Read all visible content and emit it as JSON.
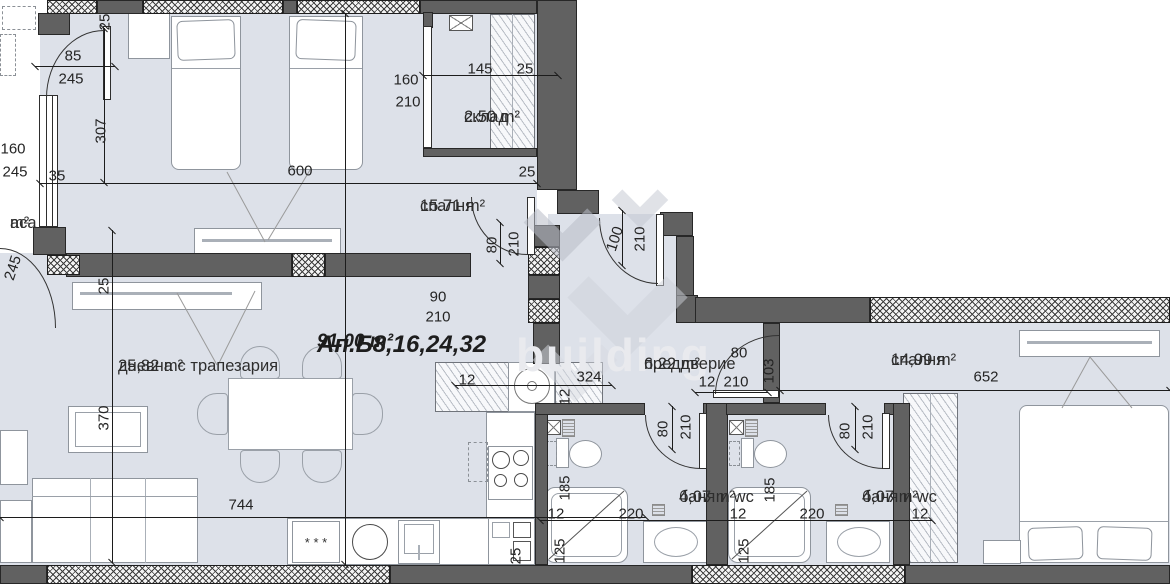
{
  "plan": {
    "apartment_title": "Ап.Б8,16,24,32",
    "apartment_total_area": "91.00 m²",
    "watermark_text": "building",
    "colors": {
      "floor": "#dde1e9",
      "wall_dark": "#616161",
      "dimension_line": "#1c1c1c"
    },
    "rooms": [
      {
        "name": "спалня",
        "area": "15.71 m²"
      },
      {
        "name": "склад",
        "area": "2.50 m²"
      },
      {
        "name": "дневна с трапезария",
        "area": "25,82 m²"
      },
      {
        "name": "преддверие",
        "area": "6.22 m²"
      },
      {
        "name": "спалня",
        "area": "14,99 m²"
      },
      {
        "name": "баня и wc",
        "area": "4,07 m²"
      },
      {
        "name": "баня и wc",
        "area": "4,07 m²"
      },
      {
        "name_partial": "аса",
        "area_partial": "m²"
      }
    ],
    "kitchen": {
      "dishwasher_symbol": "* * *"
    },
    "dimensions": [
      {
        "t": "25",
        "x": 105,
        "y": 22,
        "r": 90
      },
      {
        "t": "85",
        "x": 73,
        "y": 56,
        "r": 0
      },
      {
        "t": "245",
        "x": 71,
        "y": 79,
        "r": 0
      },
      {
        "t": "307",
        "x": 101,
        "y": 131,
        "r": 90
      },
      {
        "t": "160",
        "x": 13,
        "y": 149,
        "r": 0
      },
      {
        "t": "245",
        "x": 15,
        "y": 172,
        "r": 0
      },
      {
        "t": "35",
        "x": 57,
        "y": 176,
        "r": 0
      },
      {
        "t": "600",
        "x": 300,
        "y": 171,
        "r": 0
      },
      {
        "t": "145",
        "x": 480,
        "y": 69,
        "r": 0
      },
      {
        "t": "25",
        "x": 525,
        "y": 69,
        "r": 0
      },
      {
        "t": "160",
        "x": 406,
        "y": 80,
        "r": 0
      },
      {
        "t": "210",
        "x": 408,
        "y": 102,
        "r": 0
      },
      {
        "t": "25",
        "x": 527,
        "y": 172,
        "r": 0
      },
      {
        "t": "80",
        "x": 492,
        "y": 245,
        "r": 90
      },
      {
        "t": "210",
        "x": 514,
        "y": 244,
        "r": 90
      },
      {
        "t": "90",
        "x": 438,
        "y": 297,
        "r": 0
      },
      {
        "t": "210",
        "x": 438,
        "y": 317,
        "r": 0
      },
      {
        "t": "100",
        "x": 615,
        "y": 239,
        "r": 72
      },
      {
        "t": "210",
        "x": 640,
        "y": 239,
        "r": 90
      },
      {
        "t": "12",
        "x": 467,
        "y": 380,
        "r": 0
      },
      {
        "t": "324",
        "x": 589,
        "y": 377,
        "r": 0
      },
      {
        "t": "12",
        "x": 565,
        "y": 397,
        "r": 90
      },
      {
        "t": "80",
        "x": 739,
        "y": 353,
        "r": 0
      },
      {
        "t": "12",
        "x": 707,
        "y": 382,
        "r": 0
      },
      {
        "t": "210",
        "x": 736,
        "y": 382,
        "r": 0
      },
      {
        "t": "103",
        "x": 769,
        "y": 371,
        "r": 90
      },
      {
        "t": "652",
        "x": 986,
        "y": 377,
        "r": 0
      },
      {
        "t": "80",
        "x": 663,
        "y": 429,
        "r": 90
      },
      {
        "t": "210",
        "x": 686,
        "y": 427,
        "r": 90
      },
      {
        "t": "185",
        "x": 565,
        "y": 488,
        "r": 90
      },
      {
        "t": "12",
        "x": 556,
        "y": 514,
        "r": 0
      },
      {
        "t": "220",
        "x": 631,
        "y": 514,
        "r": 0
      },
      {
        "t": "125",
        "x": 560,
        "y": 551,
        "r": 90
      },
      {
        "t": "25",
        "x": 516,
        "y": 556,
        "r": 90
      },
      {
        "t": "80",
        "x": 845,
        "y": 431,
        "r": 90
      },
      {
        "t": "210",
        "x": 868,
        "y": 427,
        "r": 90
      },
      {
        "t": "185",
        "x": 770,
        "y": 490,
        "r": 90
      },
      {
        "t": "12",
        "x": 738,
        "y": 514,
        "r": 0
      },
      {
        "t": "220",
        "x": 812,
        "y": 514,
        "r": 0
      },
      {
        "t": "125",
        "x": 744,
        "y": 551,
        "r": 90
      },
      {
        "t": "12",
        "x": 920,
        "y": 514,
        "r": 0
      },
      {
        "t": "744",
        "x": 241,
        "y": 505,
        "r": 0
      },
      {
        "t": "370",
        "x": 104,
        "y": 418,
        "r": 90
      },
      {
        "t": "25",
        "x": 104,
        "y": 286,
        "r": 90
      },
      {
        "t": "245",
        "x": 13,
        "y": 268,
        "r": 72
      }
    ]
  }
}
